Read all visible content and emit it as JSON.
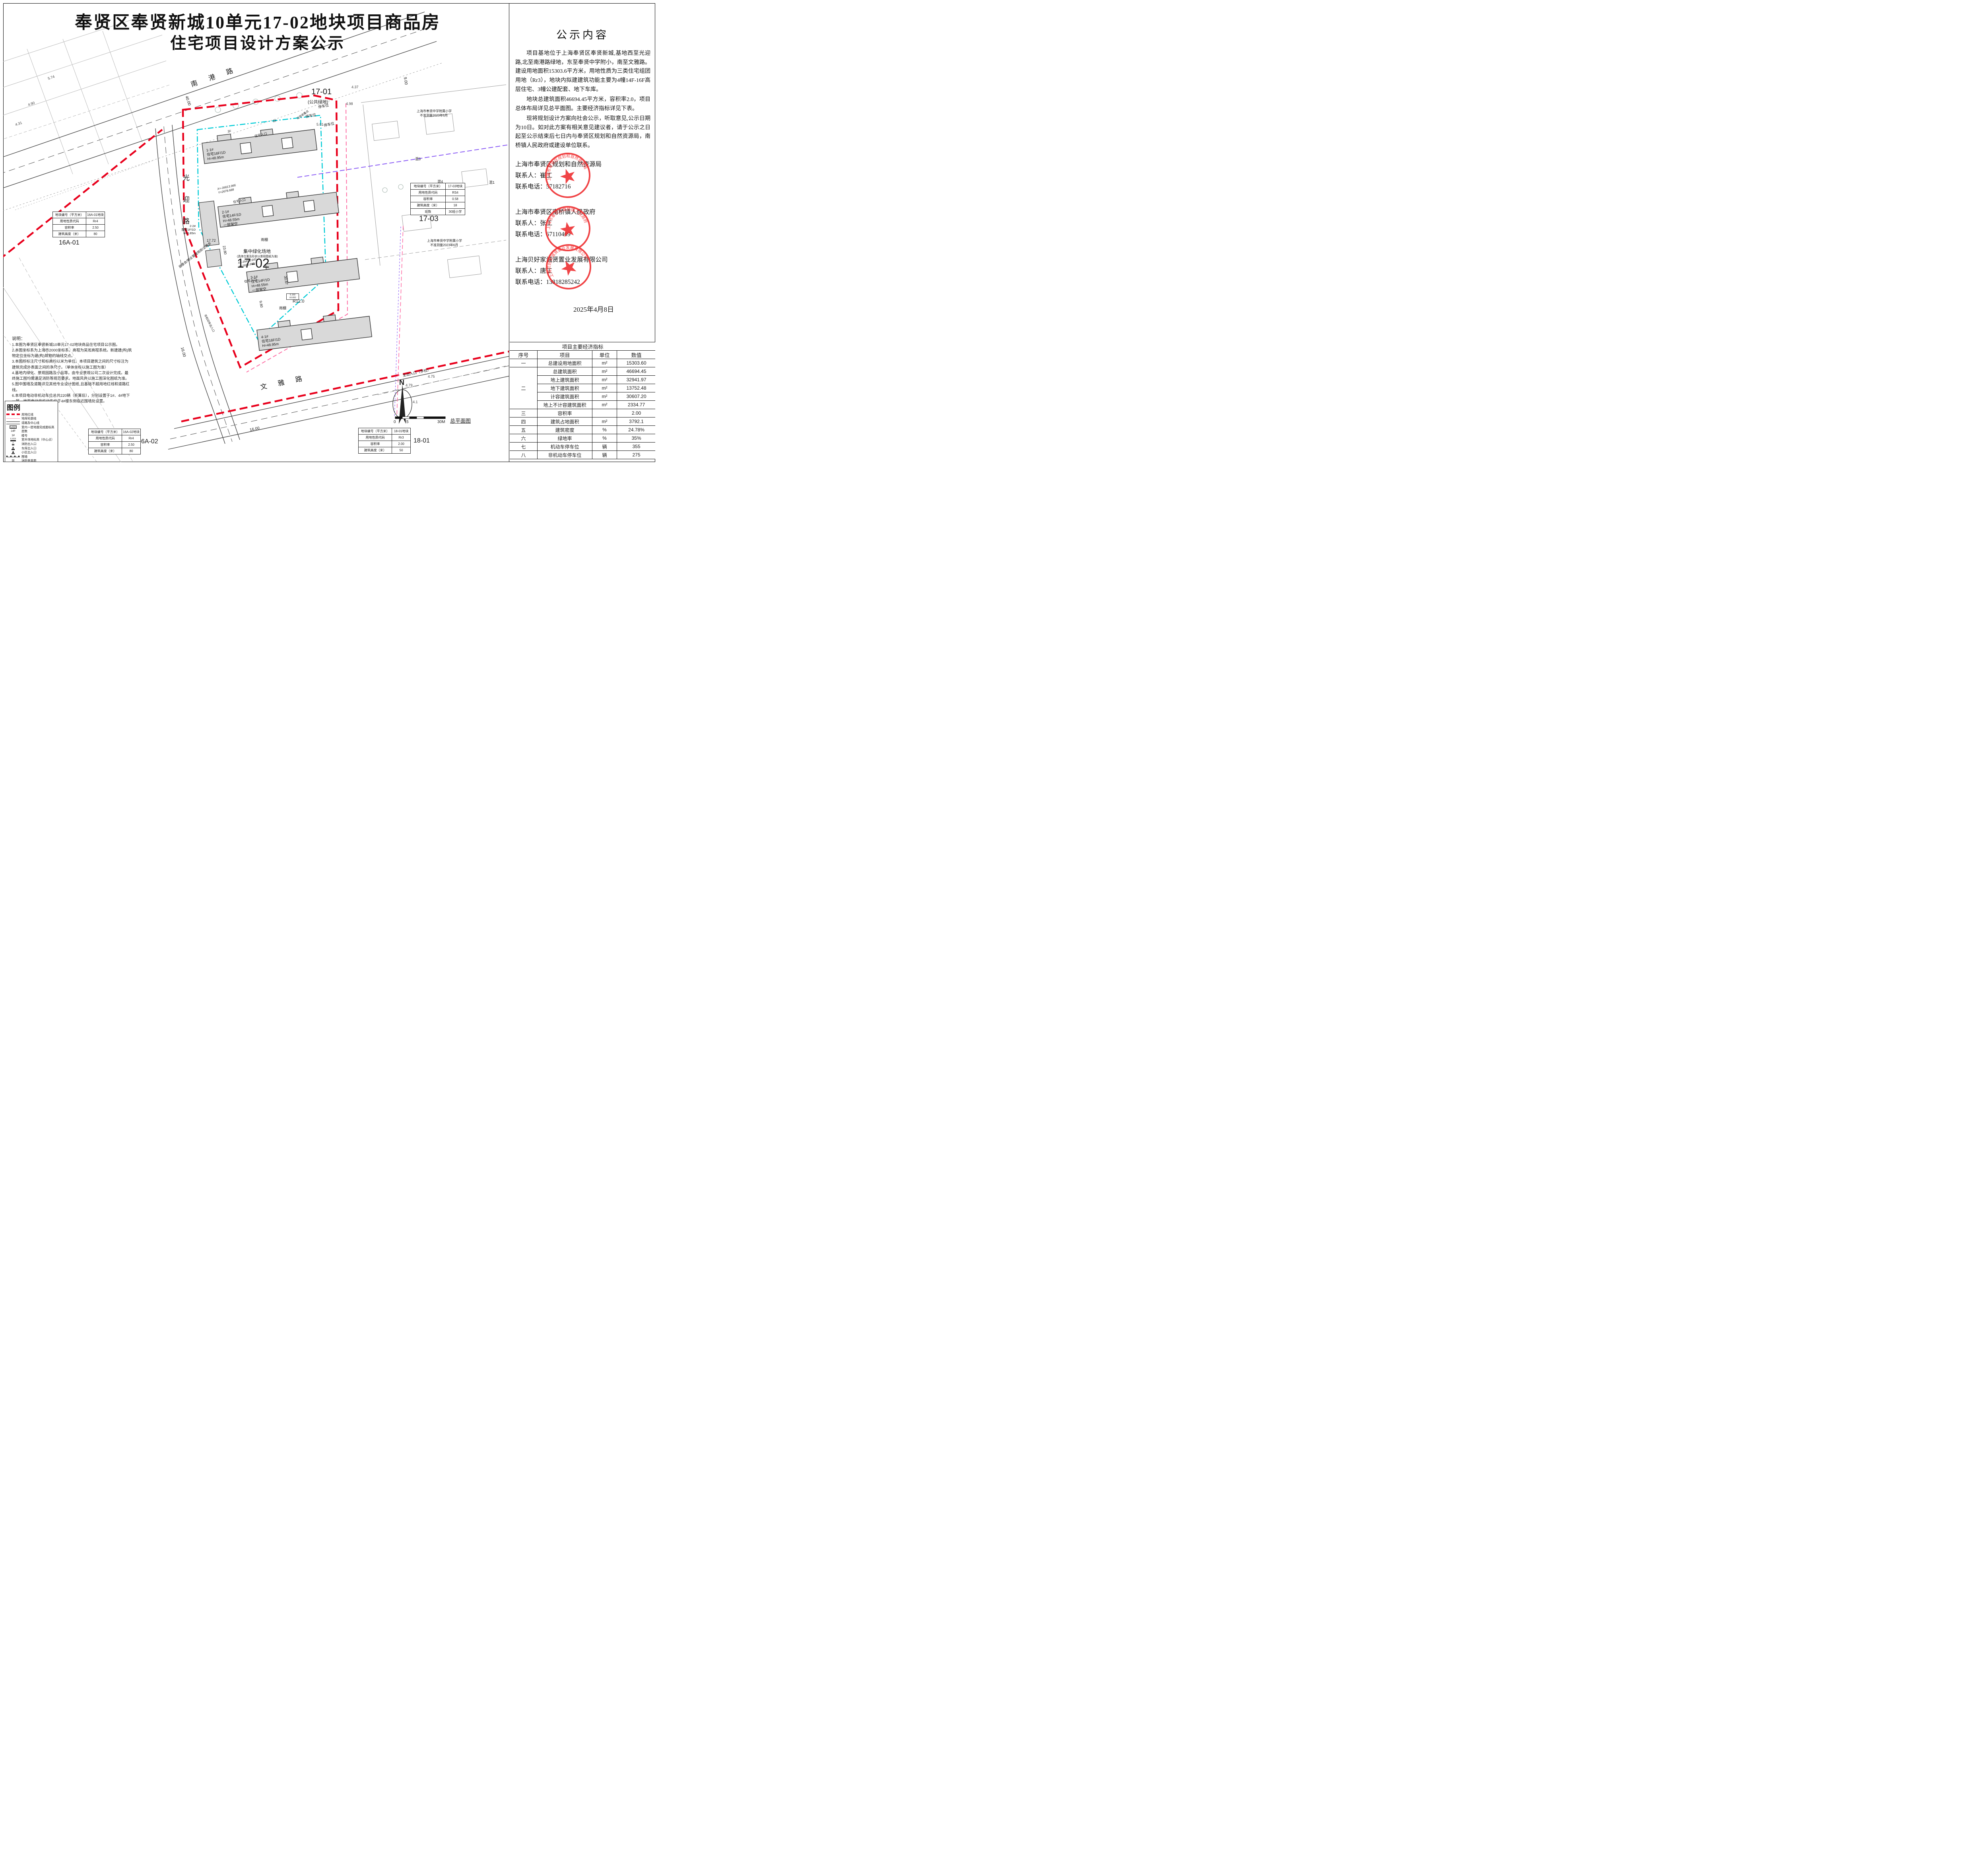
{
  "title": {
    "line1": "奉贤区奉贤新城10单元17-02地块项目商品房",
    "line2": "住宅项目设计方案公示"
  },
  "right_panel": {
    "heading": "公示内容",
    "paragraphs": {
      "p1": "项目基地位于上海奉贤区奉贤新城,基地西至光迎路,北至南港路绿地，东至奉贤中学附小，南至文雅路。建设用地面积15303.6平方米，用地性质为三类住宅组团用地（Rr3），地块内拟建建筑功能主要为4幢14F-16F高层住宅、3幢公建配套、地下车库。",
      "p2": "地块总建筑面积46694.45平方米，容积率2.0，项目总体布局详见总平面图。主要经济指标详见下表。",
      "p3": "现将规划设计方案向社会公示，听取意见,公示日期为10日。如对此方案有相关意见建议者，请于公示之日起至公示结束后七日内与奉贤区规划和自然资源局，南桥镇人民政府或建设单位联系。"
    },
    "agencies": [
      {
        "name": "上海市奉贤区规划和自然资源局",
        "contact": "联系人：崔工",
        "phone": "联系电话：57182716",
        "seal_text": "上海市奉贤区规划和自然资源局"
      },
      {
        "name": "上海市奉贤区南桥镇人民政府",
        "contact": "联系人：张工",
        "phone": "联系电话：67110409",
        "seal_text": "上海市奉贤区南桥镇人民政府"
      },
      {
        "name": "上海贝好家诚贤置业发展有限公司",
        "contact": "联系人：唐工",
        "phone": "联系电话：13818285242",
        "seal_text": "上海贝好家诚贤置业发展有限公司"
      }
    ],
    "date": "2025年4月8日"
  },
  "indicators": {
    "title": "项目主要经济指标",
    "headers": [
      "序号",
      "项目",
      "单位",
      "数值"
    ],
    "rows": [
      {
        "seq": "一",
        "item": "总建设用地面积",
        "unit": "m²",
        "value": "15303.60"
      },
      {
        "seq": "二",
        "item": "总建筑面积",
        "unit": "m²",
        "value": "46694.45"
      },
      {
        "item": "地上建筑面积",
        "unit": "m²",
        "value": "32941.97"
      },
      {
        "item": "地下建筑面积",
        "unit": "m²",
        "value": "13752.48"
      },
      {
        "item": "计容建筑面积",
        "unit": "m²",
        "value": "30607.20"
      },
      {
        "item": "地上不计容建筑面积",
        "unit": "m²",
        "value": "2334.77"
      },
      {
        "seq": "三",
        "item": "容积率",
        "unit": "",
        "value": "2.00"
      },
      {
        "seq": "四",
        "item": "建筑占地面积",
        "unit": "m²",
        "value": "3792.1"
      },
      {
        "seq": "五",
        "item": "建筑密度",
        "unit": "%",
        "value": "24.78%"
      },
      {
        "seq": "六",
        "item": "绿地率",
        "unit": "%",
        "value": "35%"
      },
      {
        "seq": "七",
        "item": "机动车停车位",
        "unit": "辆",
        "value": "355"
      },
      {
        "seq": "八",
        "item": "非机动车停车位",
        "unit": "辆",
        "value": "275"
      }
    ]
  },
  "plot_tables": [
    {
      "rows": [
        [
          "地块编号（平方米）",
          "16A-01地块"
        ],
        [
          "用地性质代码",
          "Rr4"
        ],
        [
          "容积率",
          "2.50"
        ],
        [
          "建筑高度（米）",
          "80"
        ]
      ]
    },
    {
      "rows": [
        [
          "地块编号（平方米）",
          "17-03地块"
        ],
        [
          "用地性质代码",
          "RS4"
        ],
        [
          "容积率",
          "0.58"
        ],
        [
          "建筑高度（米）",
          "18"
        ],
        [
          "班数",
          "30班小学"
        ]
      ]
    },
    {
      "rows": [
        [
          "地块编号（平方米）",
          "16A-02地块"
        ],
        [
          "用地性质代码",
          "Rr4"
        ],
        [
          "容积率",
          "2.50"
        ],
        [
          "建筑高度（米）",
          "80"
        ]
      ]
    },
    {
      "rows": [
        [
          "地块编号（平方米）",
          "18-01地块"
        ],
        [
          "用地性质代码",
          "Rr3"
        ],
        [
          "容积率",
          "2.00"
        ],
        [
          "建筑高度（米）",
          "50"
        ]
      ]
    }
  ],
  "notes": {
    "title": "说明：",
    "items": [
      "1.本图为奉贤区奉贤新城10单元17-02地块商品住宅项目公示图。",
      "2.本图坐标系为上海市2000坐标系，高程为吴淞高程系统。新建建(构)筑物定位坐标为建(构)筑物的轴线交点。",
      "3.本图所标注尺寸和标高均以米为单位。本项目建筑之间的尺寸标注为建筑完成外表面之间的净尺寸。（单体坐标以施工图为准）",
      "4.基地内绿化、景观园路及小品等，由专业景观公司二次设计完成。最终施工图均需满足消防等规范要求。地面风井以施工图深化图纸为准。",
      "5.图中围墙及道路详见其他专业设计图纸,且基础不超用地红线和道路红线。",
      "6.本项目电动非机动车位总共220辆（折算后），分别设置于1#、4#地下一层，地面电动非机动车位于4#楼东侧临近围墙处设置。"
    ]
  },
  "legend": {
    "title": "图例",
    "items": [
      {
        "label": "用地红线"
      },
      {
        "label": "地库轮廓线"
      },
      {
        "label": "道路及中心线"
      },
      {
        "label": "室内一层地面完成面标高",
        "glyph": "X.XXX"
      },
      {
        "label": "层数",
        "glyph": "14F"
      },
      {
        "label": "楼号",
        "glyph": "1#"
      },
      {
        "label": "室外场地标高（中心点）",
        "glyph": "X.XXX"
      },
      {
        "label": "消防出入口"
      },
      {
        "label": "车库出入口"
      },
      {
        "label": "小区出入口"
      },
      {
        "label": "围墙"
      },
      {
        "label": "消防登高面"
      }
    ]
  },
  "map": {
    "roads": {
      "north": "南港路",
      "west": "光迎路",
      "south": "文雅路"
    },
    "areas": {
      "a1701": "17-01",
      "a1701_sub": "(公共绿地)",
      "a1702": "17-02",
      "a1703": "17-03",
      "a16a01": "16A-01",
      "a16a02": "16A-02",
      "a1801": "18-01"
    },
    "buildings": [
      {
        "no": "1-1#",
        "type": "住宅16F/1D",
        "h": "H=48.95m",
        "extra": ""
      },
      {
        "no": "2-1#",
        "type": "住宅14F/1D",
        "h": "H=48.55m",
        "extra": "一层架空"
      },
      {
        "no": "3-1#",
        "type": "住宅14F/1D",
        "h": "H=48.55m",
        "extra": "一层架空"
      },
      {
        "no": "4-1#",
        "type": "住宅16F/1D",
        "h": "H=48.95m",
        "extra": ""
      }
    ],
    "annex": {
      "no": "2-2#",
      "type": "配套1F/1D",
      "h": "H=6.85m",
      "extra": "居委会/物业管理用房/业委会"
    },
    "labels": {
      "green": "集中绿化场地",
      "green_sub": "(具体位置及形状以景观图纸为准)",
      "school1": "上海市奉贤中学附属小学",
      "school1_sub": "不准测量2023年6月",
      "parking": "停车位",
      "canopy": "雨棚",
      "trash": "垃圾收集点",
      "entry_res": "住宅入口",
      "entry_main": "主出入口（学校）",
      "entry_nonmotor": "非机动车出入口",
      "mix1": "混1",
      "mix3": "混3",
      "mix4": "混4",
      "floor1f": "1F",
      "elev_box1": "5.150",
      "elev_box2": "±0.000",
      "caption": "总平面图",
      "north": "N"
    },
    "dims": {
      "d40": "40.00",
      "d16": "16.00",
      "d9": "9.00",
      "d3087": "30.87",
      "d980": "9.80",
      "d2380": "23.80",
      "d1772": "17.72",
      "r12": "R12.0"
    },
    "coords": {
      "x1": "X=-35613.966",
      "y1": "Y=2678.688",
      "x2": "X=-35656.642",
      "y2": "Y=2695.650"
    },
    "elevations": {
      "e574": "5.74",
      "e490": "4.90",
      "e431": "4.31",
      "e437": "4.37",
      "e498": "4.98",
      "e501": "5.01",
      "e530": "5.30",
      "e475": "4.75",
      "e479": "4.79",
      "e41": "4.1"
    },
    "scale": {
      "s0": "0",
      "s5": "5",
      "s30": "30M"
    }
  }
}
